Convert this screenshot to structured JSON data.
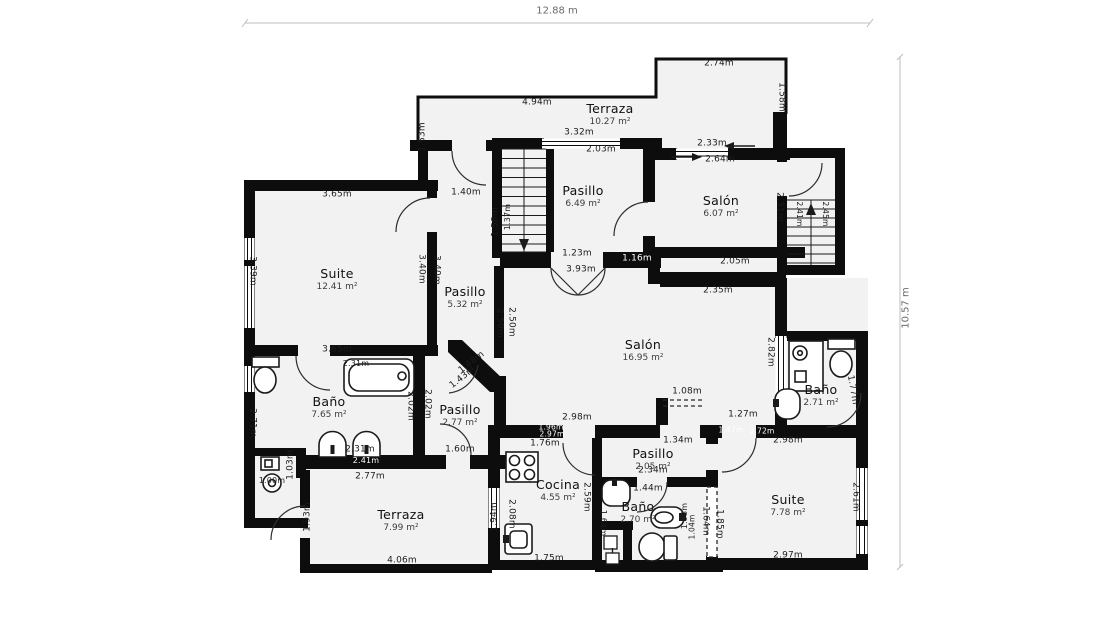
{
  "plan": {
    "overall_width": "12.88 m",
    "overall_height": "10.57 m",
    "colors": {
      "wall": "#0d0d0d",
      "room_fill": "#f2f2f2",
      "dimension_line": "#bdbdbd",
      "label_dark": "#1c1c1c",
      "label_light": "#ffffff"
    },
    "rooms": [
      {
        "name": "Terraza",
        "area": "10.27 m²",
        "x": 610,
        "y": 114
      },
      {
        "name": "Pasillo",
        "area": "6.49 m²",
        "x": 583,
        "y": 196
      },
      {
        "name": "Salón",
        "area": "6.07 m²",
        "x": 721,
        "y": 206
      },
      {
        "name": "Suite",
        "area": "12.41 m²",
        "x": 337,
        "y": 279
      },
      {
        "name": "Pasillo",
        "area": "5.32 m²",
        "x": 465,
        "y": 297
      },
      {
        "name": "Salón",
        "area": "16.95 m²",
        "x": 643,
        "y": 350
      },
      {
        "name": "Baño",
        "area": "7.65 m²",
        "x": 329,
        "y": 407
      },
      {
        "name": "Pasillo",
        "area": "2.77 m²",
        "x": 460,
        "y": 415
      },
      {
        "name": "Baño",
        "area": "2.71 m²",
        "x": 821,
        "y": 395
      },
      {
        "name": "Cocina",
        "area": "4.55 m²",
        "x": 558,
        "y": 490
      },
      {
        "name": "Pasillo",
        "area": "2.05 m²",
        "x": 653,
        "y": 459
      },
      {
        "name": "Baño",
        "area": "2.70 m²",
        "x": 638,
        "y": 512
      },
      {
        "name": "Suite",
        "area": "7.78 m²",
        "x": 788,
        "y": 505
      },
      {
        "name": "Terraza",
        "area": "7.99 m²",
        "x": 401,
        "y": 520
      }
    ],
    "labels": [
      {
        "t": "2.74m",
        "x": 719,
        "y": 64
      },
      {
        "t": "4.94m",
        "x": 537,
        "y": 103
      },
      {
        "t": "1.53m",
        "x": 423,
        "y": 137,
        "r": -90
      },
      {
        "t": "1.58m",
        "x": 781,
        "y": 97,
        "r": 90
      },
      {
        "t": "3.32m",
        "x": 579,
        "y": 133
      },
      {
        "t": "2.03m",
        "x": 601,
        "y": 150
      },
      {
        "t": "2.33m",
        "x": 712,
        "y": 144
      },
      {
        "t": "2.64m",
        "x": 720,
        "y": 160
      },
      {
        "t": "3.65m",
        "x": 337,
        "y": 195
      },
      {
        "t": "1.40m",
        "x": 466,
        "y": 193
      },
      {
        "t": "1.58m",
        "x": 496,
        "y": 222,
        "r": -90
      },
      {
        "t": "1.37m",
        "x": 508,
        "y": 217,
        "r": -90,
        "s": 8
      },
      {
        "t": "3.39m",
        "x": 252,
        "y": 271,
        "r": 90
      },
      {
        "t": "3.40m",
        "x": 421,
        "y": 269,
        "r": 90
      },
      {
        "t": "3.40m",
        "x": 436,
        "y": 270,
        "r": 90
      },
      {
        "t": "2.31m",
        "x": 779,
        "y": 207,
        "r": 90
      },
      {
        "t": "2.41m",
        "x": 799,
        "y": 214,
        "r": 90,
        "s": 7.5
      },
      {
        "t": "2.45m",
        "x": 825,
        "y": 214,
        "r": 90,
        "s": 7.5
      },
      {
        "t": "1.23m",
        "x": 577,
        "y": 254
      },
      {
        "t": "1.16m",
        "x": 637,
        "y": 259,
        "v": "light"
      },
      {
        "t": "3.93m",
        "x": 581,
        "y": 270
      },
      {
        "t": "2.05m",
        "x": 735,
        "y": 262
      },
      {
        "t": "2.35m",
        "x": 718,
        "y": 291
      },
      {
        "t": "2.50m",
        "x": 499,
        "y": 323,
        "r": 90
      },
      {
        "t": "2.50m",
        "x": 511,
        "y": 322,
        "r": 90
      },
      {
        "t": "2.82m",
        "x": 770,
        "y": 352,
        "r": 90
      },
      {
        "t": "3.65m",
        "x": 337,
        "y": 350
      },
      {
        "t": "2.31m",
        "x": 356,
        "y": 364,
        "s": 8
      },
      {
        "t": "2.02m",
        "x": 410,
        "y": 406,
        "r": 90
      },
      {
        "t": "2.02m",
        "x": 427,
        "y": 404,
        "r": 90
      },
      {
        "t": "2.71m",
        "x": 252,
        "y": 423,
        "r": 90
      },
      {
        "t": "1.48m",
        "x": 472,
        "y": 363,
        "r": -38
      },
      {
        "t": "1.43m",
        "x": 463,
        "y": 378,
        "r": -38
      },
      {
        "t": "1.03m",
        "x": 291,
        "y": 465,
        "r": -90
      },
      {
        "t": "1.00m",
        "x": 272,
        "y": 481,
        "s": 8
      },
      {
        "t": "2.31m",
        "x": 360,
        "y": 450
      },
      {
        "t": "2.41m",
        "x": 366,
        "y": 461,
        "v": "light",
        "s": 8
      },
      {
        "t": "2.77m",
        "x": 370,
        "y": 477
      },
      {
        "t": "1.60m",
        "x": 460,
        "y": 450
      },
      {
        "t": "2.98m",
        "x": 577,
        "y": 418
      },
      {
        "t": "1.96m",
        "x": 551,
        "y": 427,
        "v": "light",
        "s": 7.5
      },
      {
        "t": "2.97m",
        "x": 552,
        "y": 434,
        "v": "light",
        "s": 7.5
      },
      {
        "t": "1.76m",
        "x": 545,
        "y": 444
      },
      {
        "t": "1.08m",
        "x": 687,
        "y": 392
      },
      {
        "t": "1.27m",
        "x": 743,
        "y": 415
      },
      {
        "t": "1.47m",
        "x": 731,
        "y": 430,
        "v": "light",
        "s": 7.5
      },
      {
        "t": "2.72m",
        "x": 762,
        "y": 431,
        "v": "light",
        "s": 7.5
      },
      {
        "t": "2.98m",
        "x": 788,
        "y": 441
      },
      {
        "t": "1.34m",
        "x": 678,
        "y": 441
      },
      {
        "t": "2.34m",
        "x": 653,
        "y": 471
      },
      {
        "t": "1.44m",
        "x": 648,
        "y": 489
      },
      {
        "t": "1.93m",
        "x": 308,
        "y": 517,
        "r": -90
      },
      {
        "t": "1.94m",
        "x": 495,
        "y": 517,
        "r": -90
      },
      {
        "t": "2.08m",
        "x": 511,
        "y": 514,
        "r": 90
      },
      {
        "t": "2.59m",
        "x": 586,
        "y": 497,
        "r": 90
      },
      {
        "t": "1.64m",
        "x": 603,
        "y": 523,
        "r": 90,
        "s": 8
      },
      {
        "t": "1.93m",
        "x": 685,
        "y": 516,
        "r": -90,
        "s": 8
      },
      {
        "t": "1.04m",
        "x": 692,
        "y": 527,
        "r": -90,
        "s": 7.5
      },
      {
        "t": "1.64m",
        "x": 705,
        "y": 521,
        "r": 90
      },
      {
        "t": "1.85m",
        "x": 719,
        "y": 524,
        "r": 90
      },
      {
        "t": "2.61m",
        "x": 855,
        "y": 497,
        "r": 90
      },
      {
        "t": "1.77m",
        "x": 852,
        "y": 390,
        "r": 80
      },
      {
        "t": "4.06m",
        "x": 402,
        "y": 561
      },
      {
        "t": "1.75m",
        "x": 549,
        "y": 559
      },
      {
        "t": "2.97m",
        "x": 788,
        "y": 556
      }
    ]
  }
}
